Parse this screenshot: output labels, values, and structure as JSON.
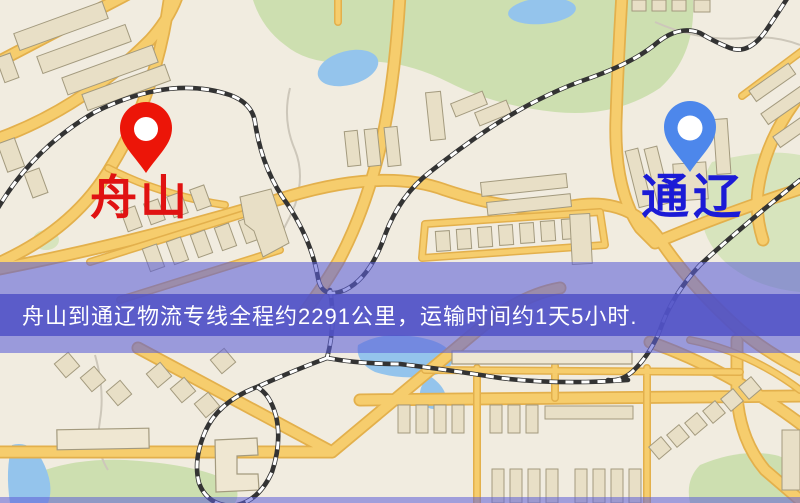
{
  "banner": {
    "text": "舟山到通辽物流专线全程约2291公里，运输时间约1天5小时.",
    "background_color": "#5c5dc9",
    "text_color": "#ffffff"
  },
  "route": {
    "origin": "舟山",
    "destination": "通辽",
    "distance_km": "2291",
    "duration": "1天5小时"
  },
  "markers": {
    "origin": {
      "label": "舟山",
      "label_color": "#e01212",
      "pin_color": "#ec1508"
    },
    "destination": {
      "label": "通辽",
      "label_color": "#1b1bd6",
      "pin_color": "#4d87eb"
    }
  },
  "map_palette": {
    "background": "#f1ece0",
    "road_fill": "#f6cd6d",
    "road_casing": "#e3b04c",
    "building": "#e8dfc6",
    "park": "#cddfb0",
    "water": "#94c4ec",
    "railway": "#333333"
  }
}
